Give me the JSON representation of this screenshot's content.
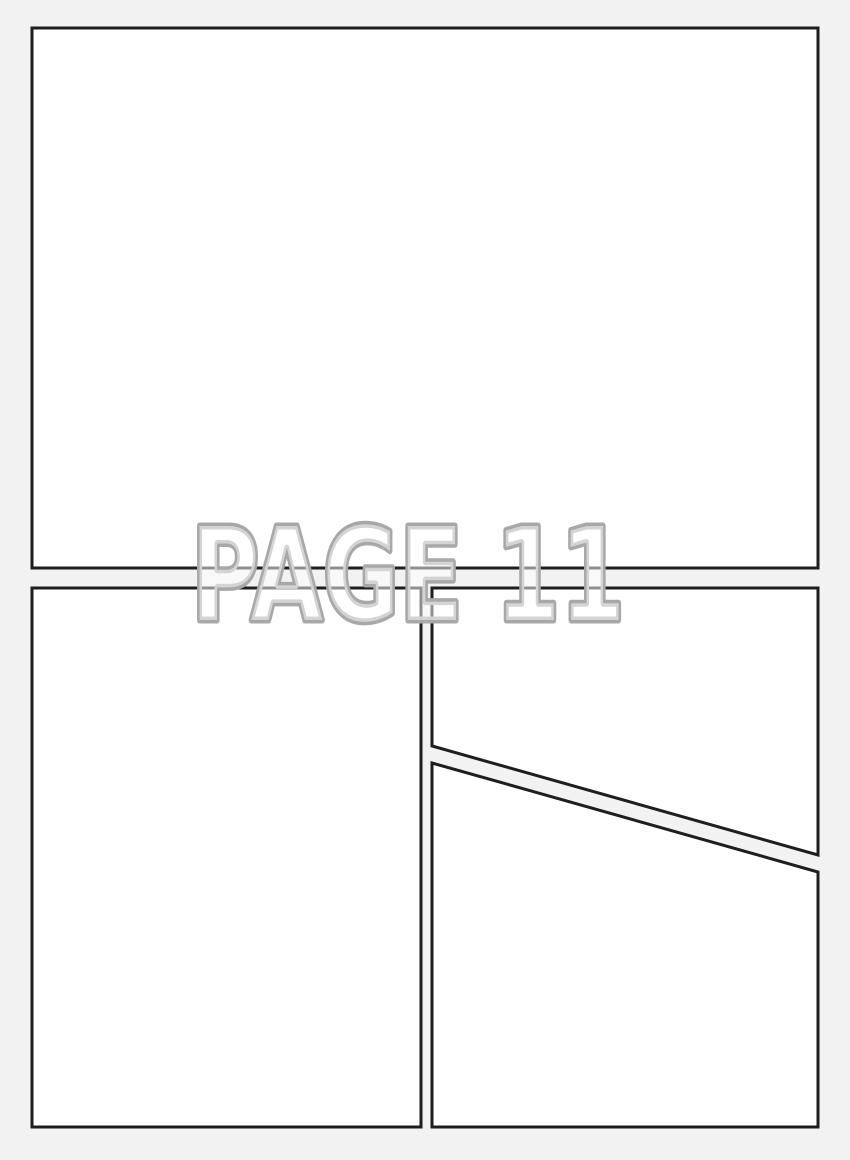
{
  "page": {
    "label": "PAGE 11"
  },
  "colors": {
    "background": "#f2f2f3",
    "panel_fill": "#ffffff",
    "panel_border": "#1e1e1e",
    "label_outline": "#a8a8a8",
    "label_fill": "rgba(255,255,255,0.5)"
  }
}
